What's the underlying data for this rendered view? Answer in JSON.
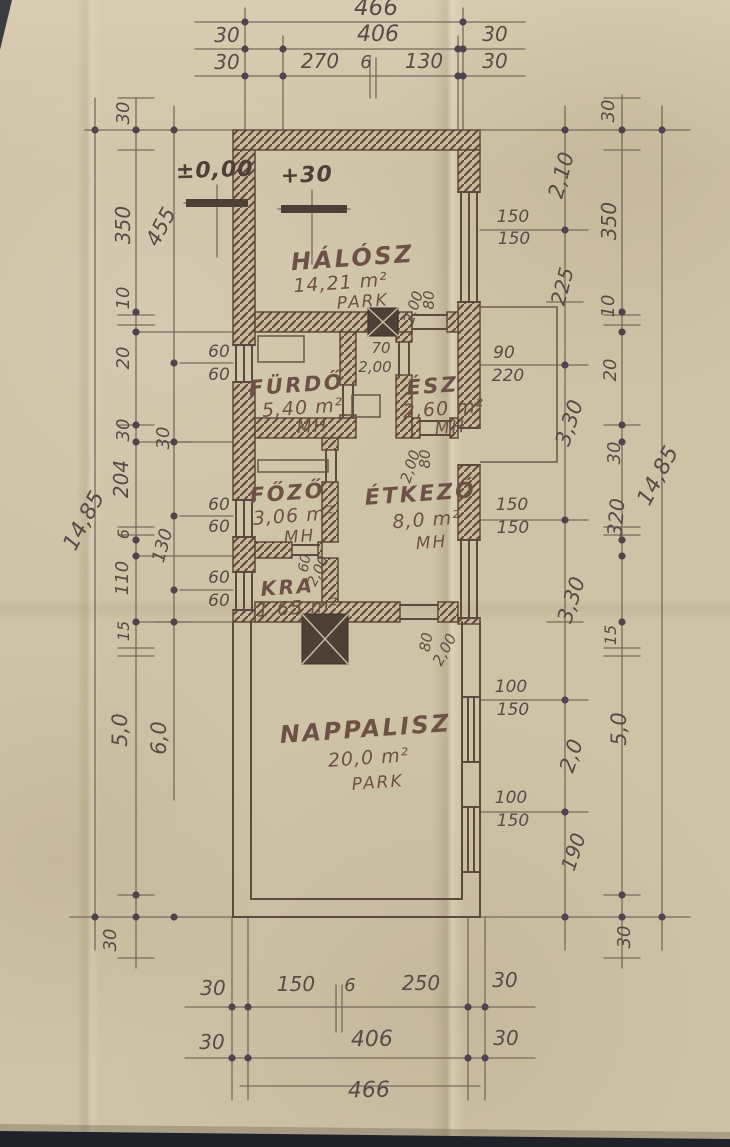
{
  "colors": {
    "paper": "#cfc3a7",
    "pencil_line": "#786a5c",
    "wall_ink": "#5b4337",
    "hatch_fill": "#c7ba9e",
    "dot": "#4f444b",
    "text": "#584d46",
    "room_text": "#6e5146",
    "photo_edge": "#20222a"
  },
  "rooms": [
    {
      "name": "HÁLÓSZ",
      "area": "14,21 m²",
      "floor": "PARK",
      "size": 24,
      "pos": {
        "nx": 353,
        "ny": 266,
        "ax": 341,
        "ay": 289,
        "fx": 363,
        "fy": 307
      }
    },
    {
      "name": "FÜRDŐ",
      "area": "5,40 m²",
      "floor": "MH",
      "size": 21,
      "pos": {
        "nx": 297,
        "ny": 392,
        "ax": 303,
        "ay": 414,
        "fx": 313,
        "fy": 432
      }
    },
    {
      "name": "ÉSZ",
      "area": "2,60 m²",
      "floor": "MH",
      "size": 21,
      "pos": {
        "nx": 433,
        "ny": 393,
        "ax": 444,
        "ay": 415,
        "fx": 451,
        "fy": 433
      }
    },
    {
      "name": "FŐZŐ",
      "area": "3,06 m²",
      "floor": "MH",
      "size": 21,
      "pos": {
        "nx": 288,
        "ny": 500,
        "ax": 294,
        "ay": 522,
        "fx": 300,
        "fy": 542
      }
    },
    {
      "name": "ÉTKEZŐ",
      "area": "8,0 m²",
      "floor": "MH",
      "size": 22,
      "pos": {
        "nx": 421,
        "ny": 501,
        "ax": 427,
        "ay": 526,
        "fx": 432,
        "fy": 548
      }
    },
    {
      "name": "KRA",
      "area": "1,65 m²",
      "floor": "",
      "size": 20,
      "pos": {
        "nx": 288,
        "ny": 594,
        "ax": 298,
        "ay": 614,
        "fx": 0,
        "fy": 0
      }
    },
    {
      "name": "NAPPALISZ",
      "area": "20,0 m²",
      "floor": "PARK",
      "size": 24,
      "pos": {
        "nx": 366,
        "ny": 737,
        "ax": 369,
        "ay": 764,
        "fx": 378,
        "fy": 788
      }
    }
  ],
  "levels": [
    {
      "t": "±0,00",
      "x": 215,
      "y": 177,
      "r": -2,
      "s": 22
    },
    {
      "t": "+30",
      "x": 307,
      "y": 182,
      "r": -2,
      "s": 22
    }
  ],
  "dims": {
    "top": [
      {
        "t": "466",
        "x": 376,
        "y": 15,
        "r": 0,
        "s": 23
      },
      {
        "t": "30",
        "x": 227,
        "y": 42,
        "r": 0,
        "s": 20
      },
      {
        "t": "406",
        "x": 378,
        "y": 41,
        "r": 0,
        "s": 22
      },
      {
        "t": "30",
        "x": 495,
        "y": 41,
        "r": 0,
        "s": 20
      },
      {
        "t": "30",
        "x": 227,
        "y": 69,
        "r": 0,
        "s": 20
      },
      {
        "t": "270",
        "x": 320,
        "y": 68,
        "r": 0,
        "s": 20
      },
      {
        "t": "6",
        "x": 366,
        "y": 68,
        "r": 0,
        "s": 18
      },
      {
        "t": "130",
        "x": 424,
        "y": 68,
        "r": 0,
        "s": 20
      },
      {
        "t": "30",
        "x": 495,
        "y": 68,
        "r": 0,
        "s": 20
      }
    ],
    "bottom": [
      {
        "t": "30",
        "x": 213,
        "y": 995,
        "r": 0,
        "s": 20
      },
      {
        "t": "150",
        "x": 296,
        "y": 991,
        "r": 0,
        "s": 20
      },
      {
        "t": "6",
        "x": 350,
        "y": 991,
        "r": 0,
        "s": 18
      },
      {
        "t": "250",
        "x": 421,
        "y": 990,
        "r": 0,
        "s": 20
      },
      {
        "t": "30",
        "x": 505,
        "y": 987,
        "r": 0,
        "s": 20
      },
      {
        "t": "30",
        "x": 212,
        "y": 1049,
        "r": 0,
        "s": 20
      },
      {
        "t": "406",
        "x": 372,
        "y": 1046,
        "r": -1,
        "s": 22
      },
      {
        "t": "30",
        "x": 506,
        "y": 1045,
        "r": 0,
        "s": 20
      },
      {
        "t": "466",
        "x": 369,
        "y": 1097,
        "r": -1,
        "s": 22
      }
    ],
    "left": [
      {
        "t": "30",
        "x": 129,
        "y": 113,
        "r": -90,
        "s": 18
      },
      {
        "t": "350",
        "x": 130,
        "y": 225,
        "r": -90,
        "s": 20
      },
      {
        "t": "455",
        "x": 167,
        "y": 230,
        "r": -62,
        "s": 21
      },
      {
        "t": "10",
        "x": 129,
        "y": 298,
        "r": -90,
        "s": 18
      },
      {
        "t": "20",
        "x": 129,
        "y": 358,
        "r": -90,
        "s": 18
      },
      {
        "t": "30",
        "x": 129,
        "y": 430,
        "r": -90,
        "s": 18
      },
      {
        "t": "30",
        "x": 169,
        "y": 438,
        "r": -90,
        "s": 18
      },
      {
        "t": "204",
        "x": 128,
        "y": 479,
        "r": -90,
        "s": 20
      },
      {
        "t": "6",
        "x": 129,
        "y": 534,
        "r": -90,
        "s": 16
      },
      {
        "t": "130",
        "x": 168,
        "y": 547,
        "r": -75,
        "s": 18
      },
      {
        "t": "110",
        "x": 128,
        "y": 578,
        "r": -90,
        "s": 18
      },
      {
        "t": "15",
        "x": 129,
        "y": 631,
        "r": -90,
        "s": 16
      },
      {
        "t": "5,0",
        "x": 127,
        "y": 730,
        "r": -90,
        "s": 21
      },
      {
        "t": "6,0",
        "x": 166,
        "y": 738,
        "r": -90,
        "s": 21
      },
      {
        "t": "14,85",
        "x": 90,
        "y": 524,
        "r": -62,
        "s": 22
      },
      {
        "t": "30",
        "x": 116,
        "y": 940,
        "r": -90,
        "s": 18
      }
    ],
    "right": [
      {
        "t": "30",
        "x": 614,
        "y": 111,
        "r": -90,
        "s": 18
      },
      {
        "t": "2,10",
        "x": 568,
        "y": 177,
        "r": -75,
        "s": 21
      },
      {
        "t": "350",
        "x": 616,
        "y": 221,
        "r": -90,
        "s": 20
      },
      {
        "t": "225",
        "x": 569,
        "y": 288,
        "r": -75,
        "s": 20
      },
      {
        "t": "10",
        "x": 614,
        "y": 306,
        "r": -90,
        "s": 18
      },
      {
        "t": "20",
        "x": 616,
        "y": 370,
        "r": -90,
        "s": 18
      },
      {
        "t": "3,30",
        "x": 576,
        "y": 425,
        "r": -72,
        "s": 21
      },
      {
        "t": "30",
        "x": 620,
        "y": 453,
        "r": -90,
        "s": 18
      },
      {
        "t": "320",
        "x": 623,
        "y": 518,
        "r": -85,
        "s": 20
      },
      {
        "t": "3,30",
        "x": 578,
        "y": 602,
        "r": -72,
        "s": 21
      },
      {
        "t": "15",
        "x": 616,
        "y": 635,
        "r": -90,
        "s": 16
      },
      {
        "t": "5,0",
        "x": 626,
        "y": 729,
        "r": -90,
        "s": 21
      },
      {
        "t": "2,0",
        "x": 578,
        "y": 758,
        "r": -72,
        "s": 21
      },
      {
        "t": "190",
        "x": 580,
        "y": 854,
        "r": -72,
        "s": 20
      },
      {
        "t": "30",
        "x": 630,
        "y": 937,
        "r": -90,
        "s": 18
      },
      {
        "t": "14,85",
        "x": 664,
        "y": 479,
        "r": -62,
        "s": 22
      }
    ],
    "windows": [
      {
        "t": "60",
        "x": 219,
        "y": 357,
        "r": 0,
        "s": 17
      },
      {
        "t": "60",
        "x": 219,
        "y": 380,
        "r": 0,
        "s": 17
      },
      {
        "t": "60",
        "x": 219,
        "y": 510,
        "r": 0,
        "s": 17
      },
      {
        "t": "60",
        "x": 219,
        "y": 532,
        "r": 0,
        "s": 17
      },
      {
        "t": "60",
        "x": 219,
        "y": 583,
        "r": 0,
        "s": 17
      },
      {
        "t": "60",
        "x": 219,
        "y": 606,
        "r": 0,
        "s": 17
      },
      {
        "t": "150",
        "x": 513,
        "y": 222,
        "r": 0,
        "s": 17
      },
      {
        "t": "150",
        "x": 514,
        "y": 244,
        "r": 0,
        "s": 17
      },
      {
        "t": "90",
        "x": 504,
        "y": 358,
        "r": 0,
        "s": 17
      },
      {
        "t": "220",
        "x": 508,
        "y": 381,
        "r": 0,
        "s": 17
      },
      {
        "t": "150",
        "x": 512,
        "y": 510,
        "r": 0,
        "s": 17
      },
      {
        "t": "150",
        "x": 513,
        "y": 533,
        "r": 0,
        "s": 17
      },
      {
        "t": "100",
        "x": 511,
        "y": 692,
        "r": 0,
        "s": 17
      },
      {
        "t": "150",
        "x": 513,
        "y": 715,
        "r": 0,
        "s": 17
      },
      {
        "t": "100",
        "x": 511,
        "y": 803,
        "r": 0,
        "s": 17
      },
      {
        "t": "150",
        "x": 513,
        "y": 826,
        "r": 0,
        "s": 17
      }
    ],
    "openings": [
      {
        "t": "80",
        "x": 434,
        "y": 300,
        "r": -90,
        "s": 15
      },
      {
        "t": "2,00",
        "x": 418,
        "y": 309,
        "r": -72,
        "s": 15
      },
      {
        "t": "70",
        "x": 381,
        "y": 353,
        "r": 0,
        "s": 15
      },
      {
        "t": "2,00",
        "x": 375,
        "y": 372,
        "r": 0,
        "s": 15
      },
      {
        "t": "80",
        "x": 430,
        "y": 459,
        "r": -90,
        "s": 15
      },
      {
        "t": "2,00",
        "x": 415,
        "y": 468,
        "r": -72,
        "s": 15
      },
      {
        "t": "60",
        "x": 309,
        "y": 564,
        "r": -80,
        "s": 14
      },
      {
        "t": "2,00",
        "x": 322,
        "y": 573,
        "r": -65,
        "s": 14
      },
      {
        "t": "80",
        "x": 431,
        "y": 643,
        "r": -80,
        "s": 15
      },
      {
        "t": "2,00",
        "x": 449,
        "y": 652,
        "r": -62,
        "s": 15
      }
    ]
  }
}
